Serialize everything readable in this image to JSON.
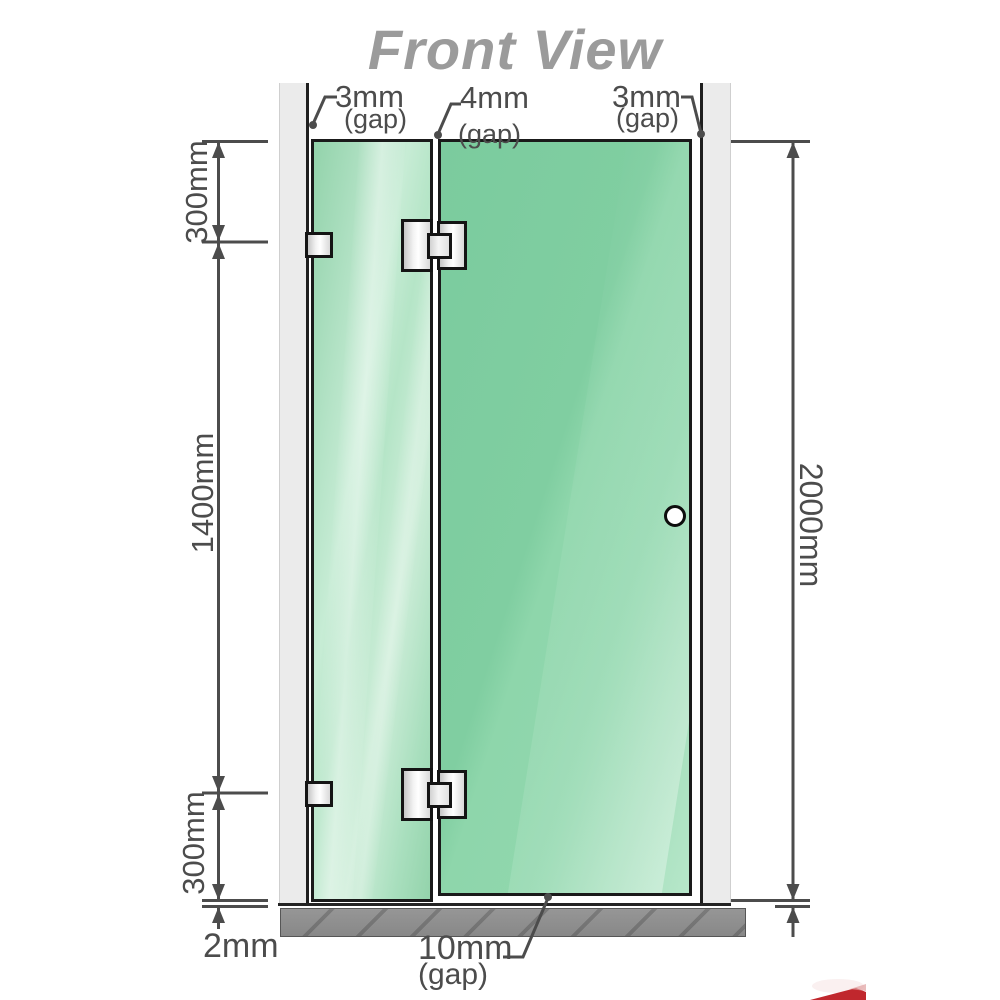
{
  "title": "Front View",
  "annotations": {
    "gap_top_left": {
      "value": "3mm",
      "suffix": "(gap)"
    },
    "gap_top_middle": {
      "value": "4mm",
      "suffix": "(gap)"
    },
    "gap_top_right": {
      "value": "3mm",
      "suffix": "(gap)"
    },
    "gap_bottom": {
      "value": "10mm",
      "suffix": "(gap)"
    },
    "dim_upper_left": "300mm",
    "dim_middle_left": "1400mm",
    "dim_lower_left": "300mm",
    "dim_base_gap": "2mm",
    "dim_total_height": "2000mm"
  },
  "colors": {
    "glass_fixed": "#b9e4ca",
    "glass_door": "#84d0a5",
    "glass_border": "#1a1a1a",
    "wall": "#ebebeb",
    "base": "#8e8e8e",
    "dimension": "#4c4c4c",
    "title": "#9b9b9b",
    "hardware_border": "#141414",
    "watermark_red": "#c0272d"
  }
}
